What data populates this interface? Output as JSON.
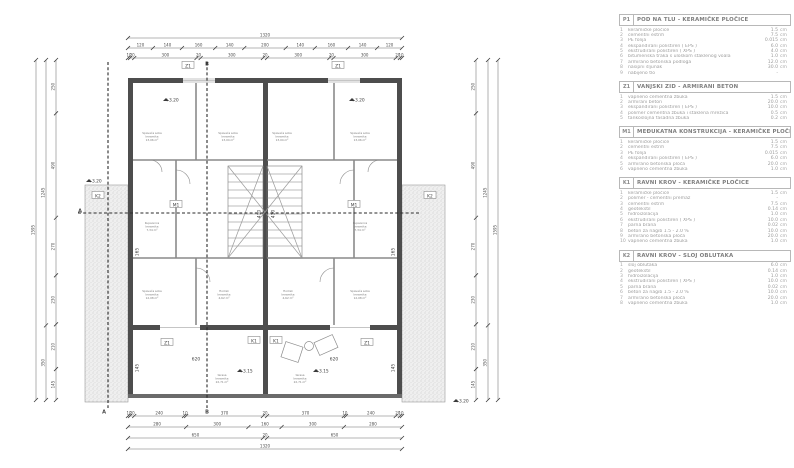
{
  "legend": {
    "sections": [
      {
        "code": "P1",
        "title": "POD NA TLU - KERAMIČKE PLOČICE",
        "items": [
          {
            "n": "1",
            "name": "keramičke pločice",
            "val": "1.5",
            "unit": "cm"
          },
          {
            "n": "2",
            "name": "cementni estrih",
            "val": "7.5",
            "unit": "cm"
          },
          {
            "n": "3",
            "name": "PE folija",
            "val": "0.015",
            "unit": "cm"
          },
          {
            "n": "4",
            "name": "ekspandirani polistiren ( EPS )",
            "val": "6.0",
            "unit": "cm"
          },
          {
            "n": "5",
            "name": "ekstrudirani polistiren ( XPS )",
            "val": "4.0",
            "unit": "cm"
          },
          {
            "n": "6",
            "name": "bitumenska traka s uloškom staklenog voala",
            "val": "1.0",
            "unit": "cm"
          },
          {
            "n": "7",
            "name": "armirano betonska podloga",
            "val": "12.0",
            "unit": "cm"
          },
          {
            "n": "8",
            "name": "nasipni šljunak",
            "val": "30.0",
            "unit": "cm"
          },
          {
            "n": "9",
            "name": "nabijeno tlo",
            "val": "-",
            "unit": ""
          }
        ]
      },
      {
        "code": "Z1",
        "title": "VANJSKI ZID - ARMIRANI BETON",
        "items": [
          {
            "n": "1",
            "name": "vapneno cementna žbuka",
            "val": "1.5",
            "unit": "cm"
          },
          {
            "n": "2",
            "name": "armirani beton",
            "val": "20.0",
            "unit": "cm"
          },
          {
            "n": "3",
            "name": "ekspandirani polistiren ( EPS )",
            "val": "10.0",
            "unit": "cm"
          },
          {
            "n": "4",
            "name": "polimer cementna žbuka i staklena mrežica",
            "val": "0.5",
            "unit": "cm"
          },
          {
            "n": "5",
            "name": "tankoslojna fasadna žbuka",
            "val": "0.2",
            "unit": "cm"
          }
        ]
      },
      {
        "code": "M1",
        "title": "MEĐUKATNA KONSTRUKCIJA - KERAMIČKE PLOČICE",
        "items": [
          {
            "n": "1",
            "name": "keramičke pločice",
            "val": "1.5",
            "unit": "cm"
          },
          {
            "n": "2",
            "name": "cementni estrih",
            "val": "7.5",
            "unit": "cm"
          },
          {
            "n": "3",
            "name": "PE folija",
            "val": "0.015",
            "unit": "cm"
          },
          {
            "n": "4",
            "name": "ekspandirani polistiren ( EPS )",
            "val": "6.0",
            "unit": "cm"
          },
          {
            "n": "5",
            "name": "armirano betonska ploča",
            "val": "20.0",
            "unit": "cm"
          },
          {
            "n": "6",
            "name": "vapneno cementna žbuka",
            "val": "1.0",
            "unit": "cm"
          }
        ]
      },
      {
        "code": "K1",
        "title": "RAVNI KROV - KERAMIČKE PLOČICE",
        "items": [
          {
            "n": "1",
            "name": "keramičke pločice",
            "val": "1.5",
            "unit": "cm"
          },
          {
            "n": "2",
            "name": "polimer - cementni premaz",
            "val": "-",
            "unit": ""
          },
          {
            "n": "3",
            "name": "cementni estrih",
            "val": "7.5",
            "unit": "cm"
          },
          {
            "n": "4",
            "name": "geotekstil",
            "val": "0.14",
            "unit": "cm"
          },
          {
            "n": "5",
            "name": "hidroizolacija",
            "val": "1.0",
            "unit": "cm"
          },
          {
            "n": "6",
            "name": "ekstrudirani polistiren ( XPS )",
            "val": "10.0",
            "unit": "cm"
          },
          {
            "n": "7",
            "name": "parna brana",
            "val": "0.02",
            "unit": "cm"
          },
          {
            "n": "8",
            "name": "beton za nagib 1.5 - 2.0 %",
            "val": "10.0",
            "unit": "cm"
          },
          {
            "n": "9",
            "name": "armirano betonska ploča",
            "val": "20.0",
            "unit": "cm"
          },
          {
            "n": "10",
            "name": "vapneno cementna žbuka",
            "val": "1.0",
            "unit": "cm"
          }
        ]
      },
      {
        "code": "K2",
        "title": "RAVNI KROV - SLOJ OBLUTAKA",
        "items": [
          {
            "n": "1",
            "name": "sloj oblutaka",
            "val": "6.0",
            "unit": "cm"
          },
          {
            "n": "2",
            "name": "geotekstil",
            "val": "0.14",
            "unit": "cm"
          },
          {
            "n": "3",
            "name": "hidroizolacija",
            "val": "1.0",
            "unit": "cm"
          },
          {
            "n": "4",
            "name": "ekstrudirani polistiren ( XPS )",
            "val": "10.0",
            "unit": "cm"
          },
          {
            "n": "5",
            "name": "parna brana",
            "val": "0.02",
            "unit": "cm"
          },
          {
            "n": "6",
            "name": "beton za nagib 1.5 - 2.0 %",
            "val": "10.0",
            "unit": "cm"
          },
          {
            "n": "7",
            "name": "armirano betonska ploča",
            "val": "20.0",
            "unit": "cm"
          },
          {
            "n": "8",
            "name": "vapneno cementna žbuka",
            "val": "1.0",
            "unit": "cm"
          }
        ]
      }
    ]
  },
  "plan": {
    "chains": [
      {
        "o": "h",
        "pos": 38,
        "from": 128,
        "to": 402,
        "segs": [
          "1320"
        ]
      },
      {
        "o": "h",
        "pos": 48,
        "from": 128,
        "to": 402,
        "segs": [
          "120",
          "140",
          "160",
          "140",
          "200",
          "140",
          "160",
          "140",
          "120"
        ]
      },
      {
        "o": "h",
        "pos": 58,
        "from": 128,
        "to": 402,
        "segs": [
          "10",
          "20",
          "300",
          "20",
          "300",
          "20",
          "300",
          "20",
          "300",
          "20",
          "10"
        ]
      },
      {
        "o": "h",
        "pos": 416,
        "from": 128,
        "to": 402,
        "segs": [
          "10",
          "20",
          "240",
          "10",
          "370",
          "20",
          "370",
          "10",
          "240",
          "20",
          "10"
        ]
      },
      {
        "o": "h",
        "pos": 427,
        "from": 128,
        "to": 402,
        "segs": [
          "280",
          "300",
          "160",
          "300",
          "280"
        ]
      },
      {
        "o": "h",
        "pos": 438,
        "from": 128,
        "to": 402,
        "segs": [
          "650",
          "20",
          "650"
        ]
      },
      {
        "o": "h",
        "pos": 449,
        "from": 128,
        "to": 402,
        "segs": [
          "1320"
        ]
      },
      {
        "o": "v",
        "pos": 36,
        "from": 60,
        "to": 400,
        "segs": [
          "1595"
        ]
      },
      {
        "o": "v",
        "pos": 46,
        "from": 60,
        "to": 400,
        "segs": [
          "1245",
          "350"
        ]
      },
      {
        "o": "v",
        "pos": 56,
        "from": 60,
        "to": 400,
        "segs": [
          "250",
          "490",
          "270",
          "230",
          "210",
          "145"
        ]
      },
      {
        "o": "v",
        "pos": 498,
        "from": 60,
        "to": 400,
        "segs": [
          "1595"
        ]
      },
      {
        "o": "v",
        "pos": 488,
        "from": 60,
        "to": 400,
        "segs": [
          "1245",
          "350"
        ]
      },
      {
        "o": "v",
        "pos": 476,
        "from": 60,
        "to": 400,
        "segs": [
          "250",
          "490",
          "270",
          "230",
          "210",
          "145"
        ]
      }
    ],
    "labels": [
      {
        "x": 188,
        "y": 66,
        "t": "Z1",
        "box": true
      },
      {
        "x": 338,
        "y": 66,
        "t": "Z1",
        "box": true
      },
      {
        "x": 167,
        "y": 343,
        "t": "Z1",
        "box": true
      },
      {
        "x": 367,
        "y": 343,
        "t": "Z1",
        "box": true
      },
      {
        "x": 254,
        "y": 341,
        "t": "K1",
        "box": true
      },
      {
        "x": 276,
        "y": 341,
        "t": "K1",
        "box": true
      },
      {
        "x": 98,
        "y": 196,
        "t": "K2",
        "box": true
      },
      {
        "x": 430,
        "y": 196,
        "t": "K2",
        "box": true
      },
      {
        "x": 176,
        "y": 205,
        "t": "M1",
        "box": true
      },
      {
        "x": 354,
        "y": 205,
        "t": "M1",
        "box": true
      },
      {
        "x": 172,
        "y": 100,
        "t": "+3.20"
      },
      {
        "x": 358,
        "y": 100,
        "t": "+3.20"
      },
      {
        "x": 95,
        "y": 181,
        "t": "+3.20"
      },
      {
        "x": 462,
        "y": 401,
        "t": "+3.20"
      },
      {
        "x": 246,
        "y": 371,
        "t": "+3.15"
      },
      {
        "x": 322,
        "y": 371,
        "t": "+3.15"
      },
      {
        "x": 196,
        "y": 359,
        "t": "620"
      },
      {
        "x": 334,
        "y": 359,
        "t": "620"
      },
      {
        "x": 259,
        "y": 214,
        "t": "410",
        "r": -90
      },
      {
        "x": 273,
        "y": 214,
        "t": "410",
        "r": -90
      },
      {
        "x": 137,
        "y": 252,
        "t": "165",
        "r": -90
      },
      {
        "x": 393,
        "y": 252,
        "t": "165",
        "r": -90
      },
      {
        "x": 137,
        "y": 368,
        "t": "145",
        "r": -90
      },
      {
        "x": 393,
        "y": 368,
        "t": "145",
        "r": -90
      },
      {
        "x": 104,
        "y": 412,
        "t": "A",
        "b": true
      },
      {
        "x": 207,
        "y": 412,
        "t": "B",
        "b": true
      },
      {
        "x": 207,
        "y": 64,
        "t": "B",
        "b": true
      },
      {
        "x": 80,
        "y": 211,
        "t": "A",
        "b": true
      }
    ],
    "rooms": [
      {
        "x": 152,
        "y": 134,
        "lines": [
          "Spavaća soba",
          "keramika",
          "13,06 m²"
        ]
      },
      {
        "x": 228,
        "y": 134,
        "lines": [
          "Spavaća soba",
          "keramika",
          "13,04 m²"
        ]
      },
      {
        "x": 282,
        "y": 134,
        "lines": [
          "Spavaća soba",
          "keramika",
          "13,04 m²"
        ]
      },
      {
        "x": 360,
        "y": 134,
        "lines": [
          "Spavaća soba",
          "keramika",
          "13,06 m²"
        ]
      },
      {
        "x": 152,
        "y": 224,
        "lines": [
          "Kupaonica",
          "keramika",
          "7,34 m²"
        ]
      },
      {
        "x": 360,
        "y": 224,
        "lines": [
          "Kupaonica",
          "keramika",
          "7,34 m²"
        ]
      },
      {
        "x": 152,
        "y": 292,
        "lines": [
          "Spavaća soba",
          "keramika",
          "12,08 m²"
        ]
      },
      {
        "x": 360,
        "y": 292,
        "lines": [
          "Spavaća soba",
          "keramika",
          "12,08 m²"
        ]
      },
      {
        "x": 224,
        "y": 292,
        "lines": [
          "Hodnik",
          "keramika",
          "4,62 m²"
        ]
      },
      {
        "x": 288,
        "y": 292,
        "lines": [
          "Hodnik",
          "keramika",
          "4,62 m²"
        ]
      },
      {
        "x": 222,
        "y": 376,
        "lines": [
          "terasa",
          "keramika",
          "22,71 m²"
        ]
      },
      {
        "x": 300,
        "y": 376,
        "lines": [
          "terasa",
          "keramika",
          "22,71 m²"
        ]
      }
    ]
  }
}
